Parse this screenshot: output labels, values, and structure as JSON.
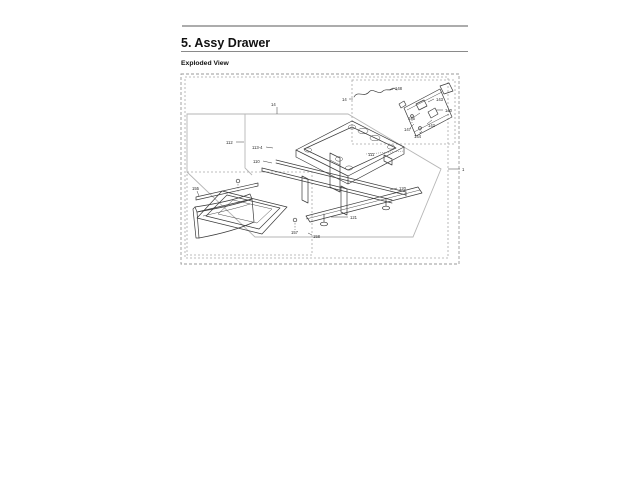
{
  "header": {
    "title": "5.  Assy Drawer",
    "subtitle": "Exploded View",
    "rule_color": "#5a5a5a",
    "underline_color": "#8a8a8a"
  },
  "figure": {
    "art_color": "#3a3a3a",
    "border_color": "#9a9a9a",
    "plane_color": "#b6b6b6",
    "assembly_callout": "1",
    "subassembly_callout": "14",
    "callouts": [
      {
        "text": "14",
        "x": 271,
        "y": 106,
        "leader": [
          277,
          107,
          277,
          114
        ]
      },
      {
        "text": "1",
        "x": 462,
        "y": 171,
        "leader": [
          460,
          169,
          448,
          169
        ]
      },
      {
        "text": "112",
        "x": 226,
        "y": 144,
        "leader": [
          236,
          142,
          244,
          142
        ]
      },
      {
        "text": "113-4",
        "x": 252,
        "y": 149,
        "leader": [
          266,
          147,
          273,
          148
        ]
      },
      {
        "text": "110",
        "x": 253,
        "y": 163,
        "leader": [
          263,
          161,
          272,
          163
        ]
      },
      {
        "text": "111",
        "x": 368,
        "y": 156,
        "leader": [
          366,
          154,
          404,
          151
        ],
        "dotted": true
      },
      {
        "text": "120",
        "x": 399,
        "y": 190,
        "leader": [
          397,
          188,
          390,
          190
        ]
      },
      {
        "text": "121",
        "x": 350,
        "y": 219,
        "leader": [
          348,
          217,
          331,
          217
        ]
      },
      {
        "text": "158",
        "x": 313,
        "y": 238,
        "leader": [
          312,
          235,
          308,
          233
        ]
      },
      {
        "text": "155",
        "x": 192,
        "y": 190,
        "leader": [
          197,
          191,
          199,
          196
        ]
      },
      {
        "text": "157",
        "x": 291,
        "y": 234
      },
      {
        "text": "14",
        "x": 342,
        "y": 101,
        "leader": [
          349,
          99,
          353,
          99
        ]
      },
      {
        "text": "148",
        "x": 395,
        "y": 90,
        "leader": [
          393,
          88,
          389,
          90
        ]
      },
      {
        "text": "143",
        "x": 436,
        "y": 101,
        "leader": [
          434,
          99,
          428,
          102
        ]
      },
      {
        "text": "140",
        "x": 445,
        "y": 112,
        "leader": [
          443,
          110,
          436,
          110
        ]
      },
      {
        "text": "145",
        "x": 408,
        "y": 120,
        "leader": [
          414,
          117,
          420,
          113
        ]
      },
      {
        "text": "142",
        "x": 428,
        "y": 127,
        "leader": [
          427,
          124,
          432,
          120
        ]
      },
      {
        "text": "147",
        "x": 404,
        "y": 131,
        "leader": [
          410,
          128,
          414,
          124
        ]
      },
      {
        "text": "144",
        "x": 414,
        "y": 138,
        "leader": [
          419,
          135,
          422,
          131
        ]
      }
    ]
  }
}
